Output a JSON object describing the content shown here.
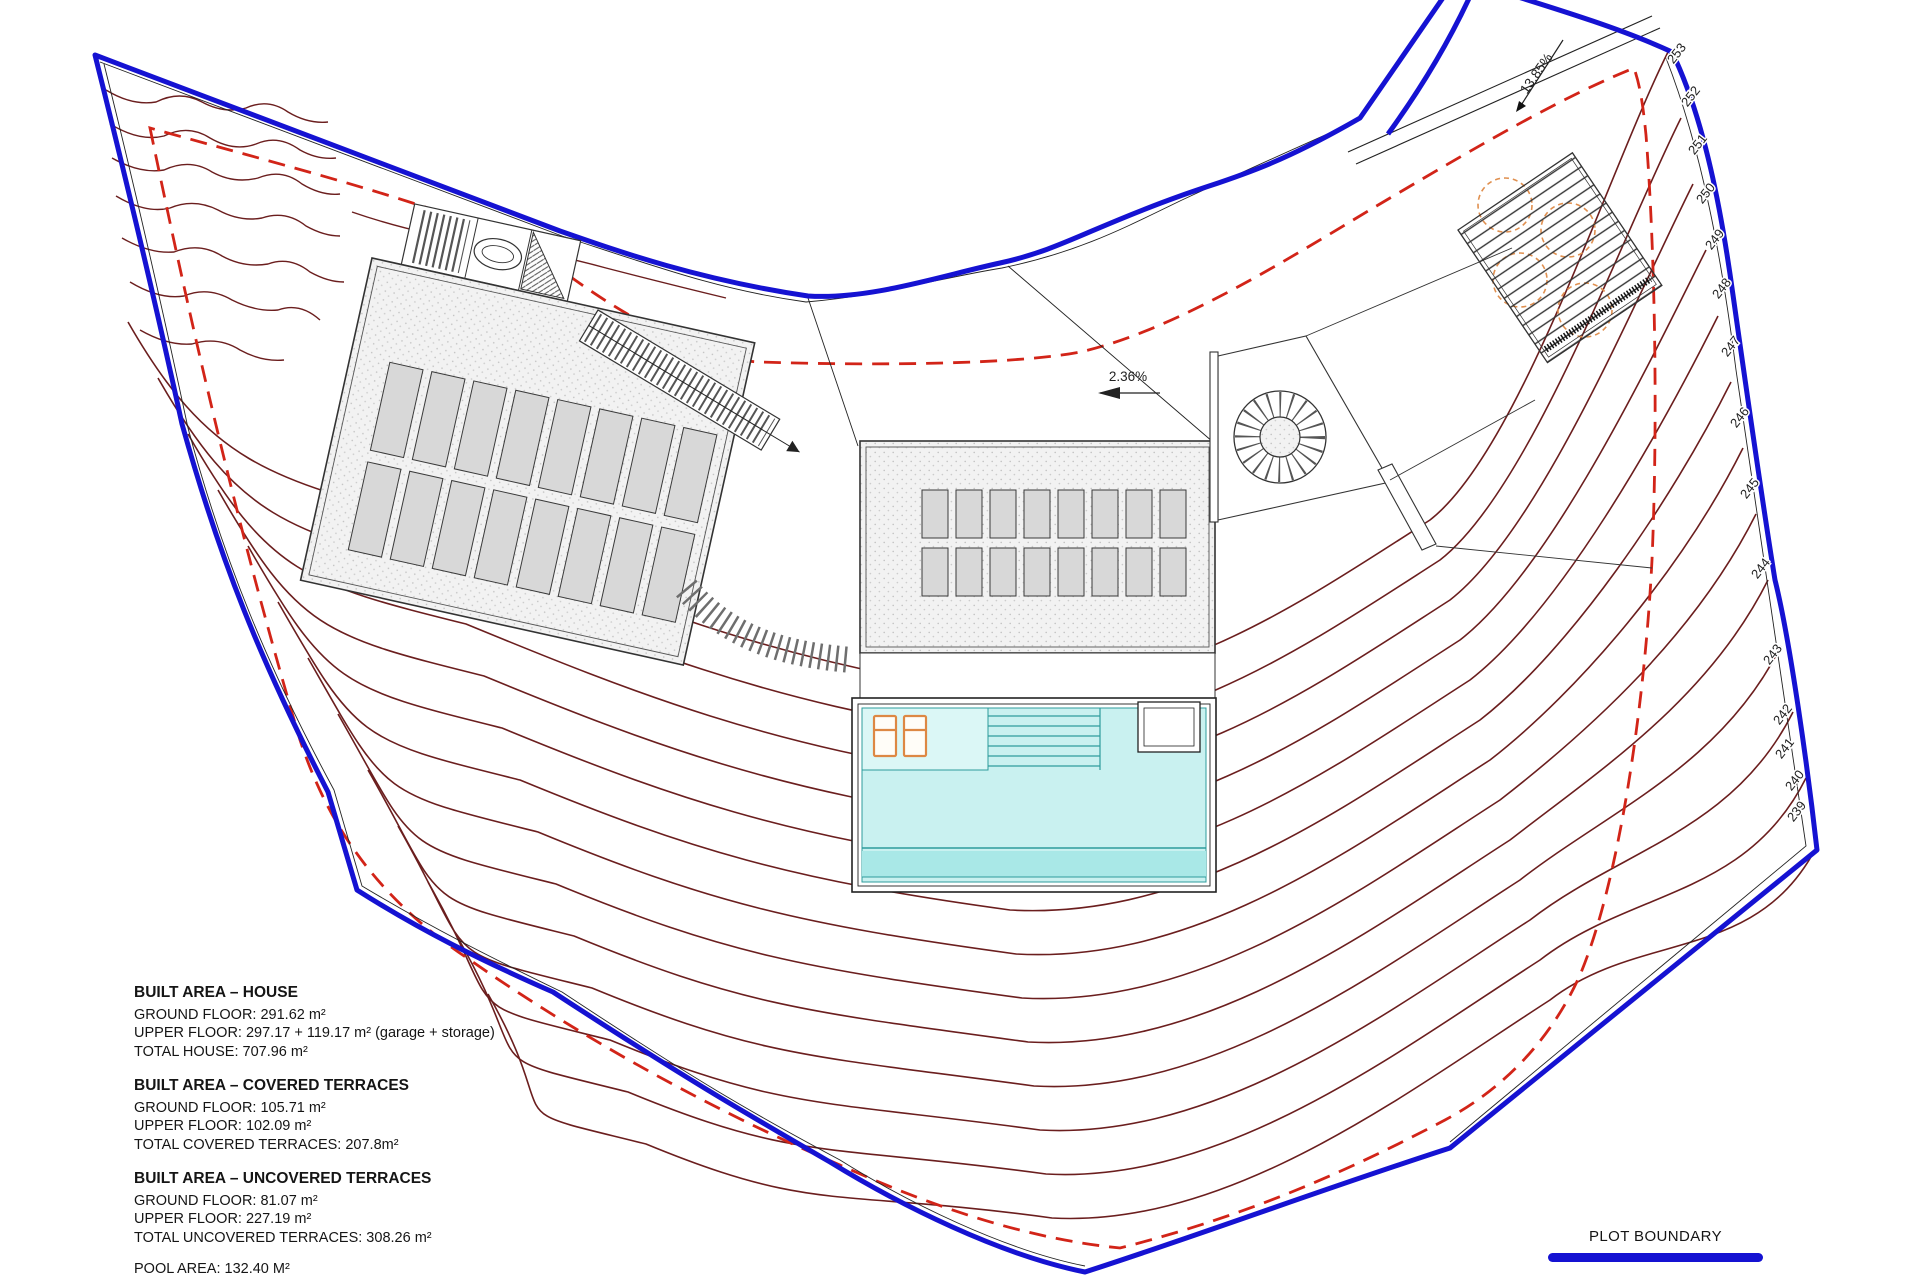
{
  "annotations": {
    "slope_main": "2.36%",
    "slope_driveway": "13.85%"
  },
  "contour_labels": [
    "253",
    "252",
    "251",
    "250",
    "249",
    "248",
    "247",
    "246",
    "245",
    "244",
    "243",
    "242",
    "241",
    "240",
    "239"
  ],
  "areas": {
    "house": {
      "title": "BUILT AREA – HOUSE",
      "lines": [
        "GROUND FLOOR: 291.62 m²",
        "UPPER FLOOR: 297.17 + 119.17 m² (garage + storage)",
        "TOTAL HOUSE: 707.96 m²"
      ]
    },
    "covered": {
      "title": "BUILT AREA – COVERED TERRACES",
      "lines": [
        "GROUND FLOOR: 105.71 m²",
        "UPPER FLOOR: 102.09 m²",
        "TOTAL COVERED TERRACES: 207.8m²"
      ]
    },
    "uncovered": {
      "title": "BUILT AREA – UNCOVERED TERRACES",
      "lines": [
        "GROUND FLOOR: 81.07 m²",
        "UPPER FLOOR: 227.19 m²",
        "TOTAL UNCOVERED TERRACES: 308.26 m²"
      ]
    },
    "pool_line": "POOL AREA: 132.40 M²"
  },
  "legend": {
    "plot_boundary": "PLOT BOUNDARY"
  },
  "colors": {
    "plot_boundary": "#1512d2",
    "contour": "#6b1e1e",
    "setback_dashed": "#d22418",
    "pool_water": "#c9f1f0",
    "pool_deck": "#dbf7f6",
    "pool_edge_band": "#a9e8e7",
    "lounger_orange": "#dd8844",
    "tree_orange": "#e09050"
  }
}
